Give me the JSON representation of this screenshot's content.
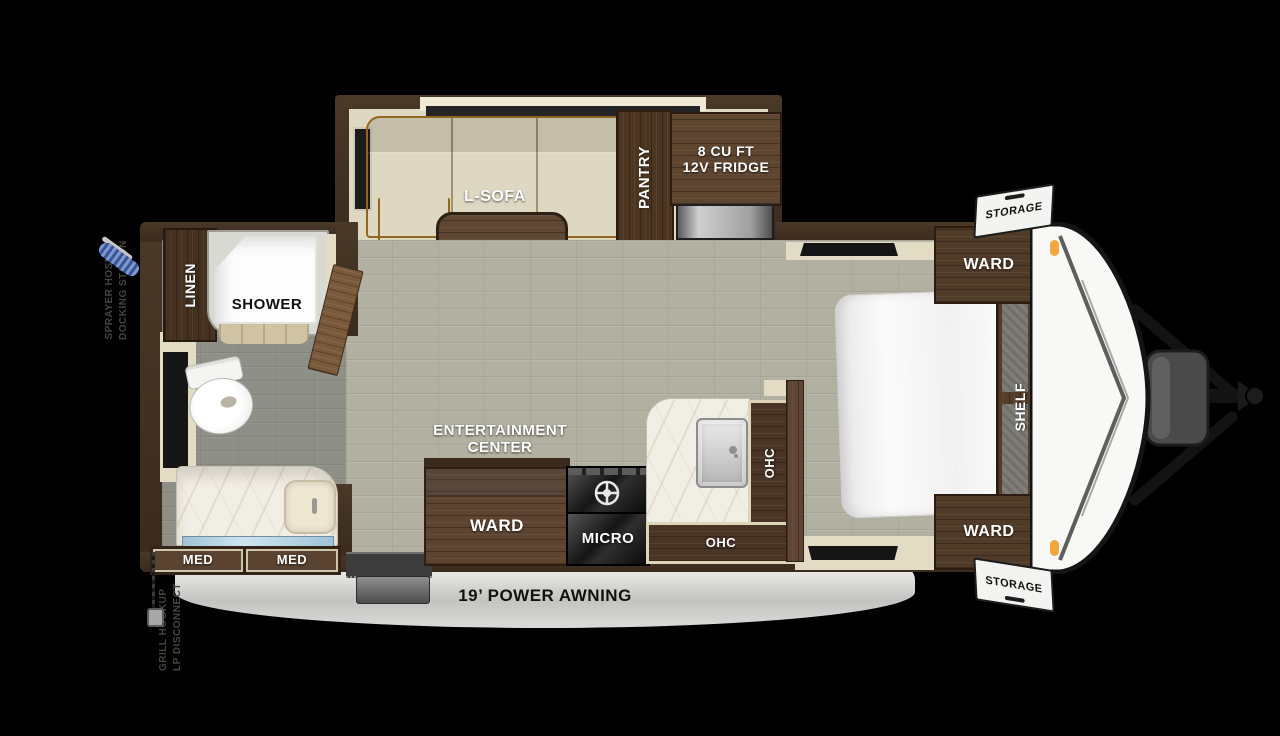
{
  "diagram": {
    "title": "Travel trailer floor plan",
    "awning_label": "19’ POWER AWNING"
  },
  "exterior": {
    "storage_top": "STORAGE",
    "storage_bottom": "STORAGE",
    "sprayer_line1": "SPRAYER HOSE",
    "sprayer_line2": "DOCKING STATION",
    "grill_line1": "GRILL HOOKUP",
    "grill_line2": "LP DISCONNECT"
  },
  "living": {
    "sofa": "L-SOFA",
    "table": "TABLE",
    "pantry": "PANTRY",
    "fridge_line1": "8 CU FT",
    "fridge_line2": "12V FRIDGE",
    "entertainment_line1": "ENTERTAINMENT",
    "entertainment_line2": "CENTER"
  },
  "kitchen": {
    "ward": "WARD",
    "micro": "MICRO",
    "ohc_upper": "OHC",
    "ohc_lower": "OHC"
  },
  "bedroom": {
    "ward_top": "WARD",
    "ward_bottom": "WARD",
    "shelf": "SHELF"
  },
  "bathroom": {
    "linen": "LINEN",
    "shower": "SHOWER",
    "med_left": "MED",
    "med_right": "MED"
  },
  "colors": {
    "wall_brown": "#42301f",
    "wood_cabinet": "#55402c",
    "floor_main": "#b2b0a0",
    "floor_bath": "#8e8f86",
    "trim_cream": "#e3dcc5",
    "sofa_tan": "#c4944a",
    "marble": "#f1eee5",
    "awning_gray": "#d4d4d4",
    "marker_light_orange": "#f2a63c",
    "hose_blue": "#5a7ab8"
  }
}
